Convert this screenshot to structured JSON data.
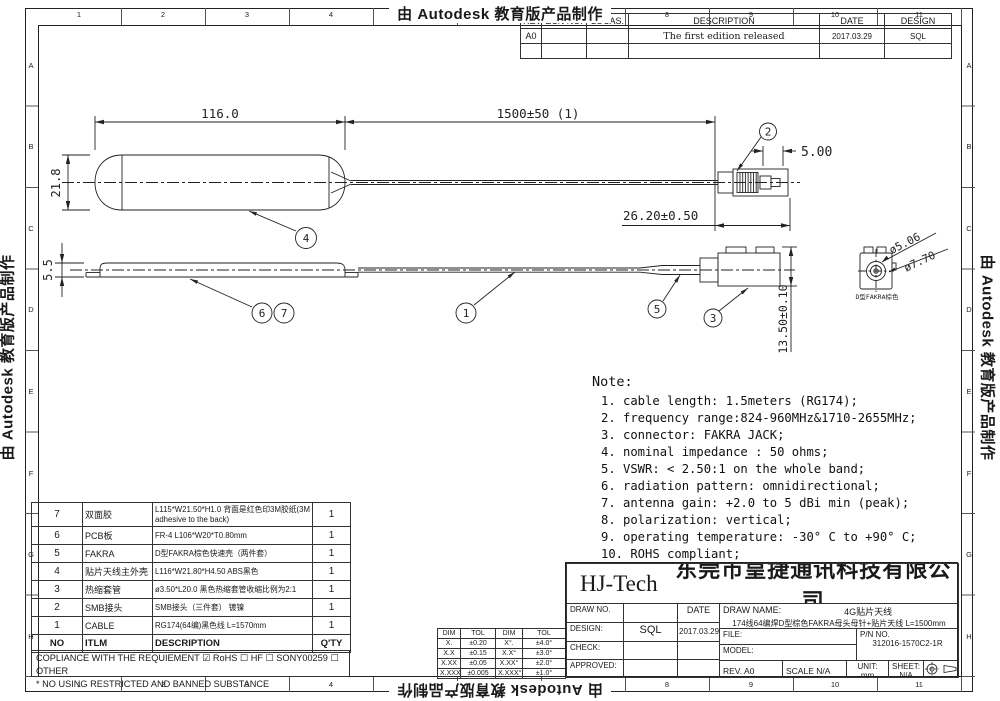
{
  "watermark": "由 Autodesk 教育版产品制作",
  "border": {
    "columns": [
      "1",
      "2",
      "3",
      "4",
      "5",
      "6",
      "7",
      "8",
      "9",
      "10",
      "11"
    ],
    "rows": [
      "A",
      "B",
      "C",
      "D",
      "E",
      "F",
      "G",
      "H"
    ]
  },
  "revision_table": {
    "headers": [
      "REV.",
      "ECN NO.",
      "LOCAS.",
      "DESCRIPTION",
      "DATE",
      "DESIGN"
    ],
    "row": {
      "rev": "A0",
      "ecn": "",
      "locas": "",
      "description": "The first edition released",
      "date": "2017.03.29",
      "design": "SQL"
    }
  },
  "drawing": {
    "dim_body_length": "116.0",
    "dim_cable_length": "1500±50 (1)",
    "dim_body_width": "21.8",
    "dim_body_height": "5.5",
    "dim_smb_tip": "5.00",
    "dim_smb_length": "26.20±0.50",
    "dim_fakra_height": "13.50±0.10",
    "dim_fakra_pin_dia": "ø5.06",
    "dim_fakra_body_dia": "ø7.70",
    "detail_label": "D型FAKRA棕色",
    "balloons": [
      "1",
      "2",
      "3",
      "4",
      "5",
      "6",
      "7"
    ]
  },
  "notes": {
    "title": "Note:",
    "items": [
      "1. cable length: 1.5meters (RG174);",
      "2. frequency range:824-960MHz&1710-2655MHz;",
      "3. connector: FAKRA JACK;",
      "4. nominal impedance : 50 ohms;",
      "5. VSWR: < 2.50:1 on the whole band;",
      "6. radiation pattern: omnidirectional;",
      "7. antenna gain: +2.0 to 5 dBi min (peak);",
      "8. polarization: vertical;",
      "9. operating temperature: -30° C to +90° C;",
      "10. ROHS compliant;"
    ]
  },
  "parts_table": {
    "headers": {
      "no": "NO",
      "item": "ITLM",
      "desc": "DESCRIPTION",
      "qty": "Q'TY"
    },
    "rows": [
      {
        "no": "7",
        "item": "双面胶",
        "desc": "L115*W21.50*H1.0 背面是红色印3M胶纸(3M adhesive to the back)",
        "qty": "1"
      },
      {
        "no": "6",
        "item": "PCB板",
        "desc": "FR-4 L106*W20*T0.80mm",
        "qty": "1"
      },
      {
        "no": "5",
        "item": "FAKRA",
        "desc": "D型FAKRA棕色快速壳（两件套）",
        "qty": "1"
      },
      {
        "no": "4",
        "item": "贴片天线主外壳",
        "desc": "L116*W21.80*H4.50 ABS黑色",
        "qty": "1"
      },
      {
        "no": "3",
        "item": "热缩套管",
        "desc": "ø3.50*L20.0 黑色热缩套管收缩比例为2:1",
        "qty": "1"
      },
      {
        "no": "2",
        "item": "SMB接头",
        "desc": "SMB接头（三件套） 镀镍",
        "qty": "1"
      },
      {
        "no": "1",
        "item": "CABLE",
        "desc": "RG174(64编)黑色线 L=1570mm",
        "qty": "1"
      }
    ],
    "compliance": "COPLIANCE WITH THE REQUIEMENT ☑ RoHS ☐ HF ☐ SONY00259 ☐ OTHER",
    "substance": "* NO USING RESTRICTED AND BANNED SUBSTANCE"
  },
  "tolerance_table": {
    "rows": [
      [
        "DIM",
        "TOL",
        "DIM",
        "TOL"
      ],
      [
        "X.",
        "±0.20",
        "X°.",
        "±4.0°"
      ],
      [
        "X.X",
        "±0.15",
        "X.X°",
        "±3.0°"
      ],
      [
        "X.XX",
        "±0.05",
        "X.XX°",
        "±2.0°"
      ],
      [
        "X.XXX",
        "±0.005",
        "X.XXX°",
        "±1.0°"
      ]
    ]
  },
  "title_block": {
    "company_short": "HJ-Tech",
    "company_full": "东莞市皇捷通讯科技有限公司",
    "draw_no_label": "DRAW NO.",
    "date_label": "DATE",
    "design_label": "DESIGN:",
    "design_value": "SQL",
    "design_date": "2017.03.29",
    "check_label": "CHECK:",
    "approved_label": "APPROVED:",
    "draw_name_label": "DRAW NAME:",
    "draw_name_value": "4G贴片天线",
    "draw_name_sub": "174线64编焊D型棕色FAKRA母头母针+贴片天线 L=1500mm",
    "file_label": "FILE:",
    "model_label": "MODEL:",
    "pn_label": "P/N NO.",
    "pn_value": "312016-1570C2-1R",
    "rev_label": "REV. A0",
    "scale_label": "SCALE N/A",
    "unit_label": "UNIT:",
    "unit_value": "mm",
    "sheet_label": "SHEET:",
    "sheet_value": "N/A"
  }
}
